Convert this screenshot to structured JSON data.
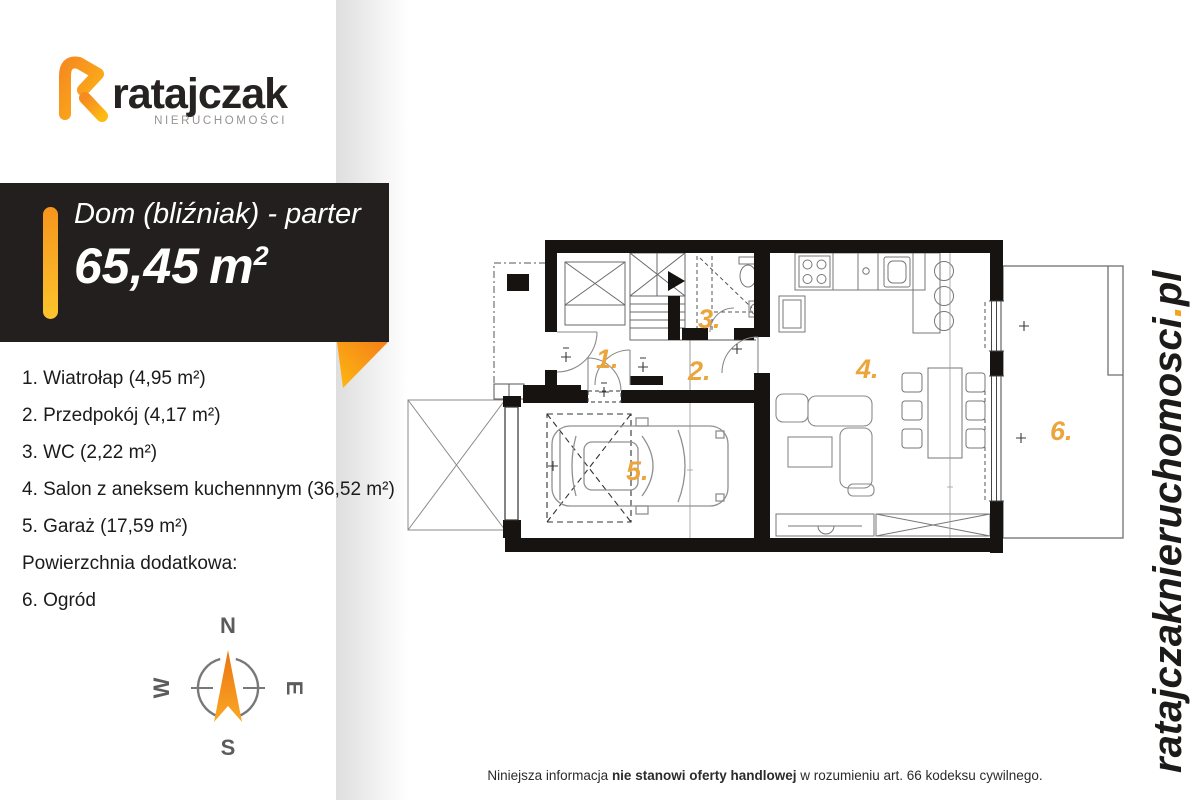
{
  "colors": {
    "accent_orange": "#F0A132",
    "banner_background": "#221F1E",
    "wall_black": "#171310"
  },
  "brand": {
    "name": "ratajczak",
    "tagline": "NIERUCHOMOŚCI"
  },
  "banner": {
    "title": "Dom (bliźniak) - parter",
    "area_value": "65,45",
    "area_unit": "m",
    "area_sup": "2"
  },
  "room_list": {
    "items": [
      {
        "label": "1. Wiatrołap (4,95 m²)"
      },
      {
        "label": "2. Przedpokój (4,17 m²)"
      },
      {
        "label": "3. WC (2,22 m²)"
      },
      {
        "label": "4. Salon z aneksem kuchennnym (36,52 m²)"
      },
      {
        "label": "5. Garaż (17,59 m²)"
      },
      {
        "label": "Powierzchnia dodatkowa:"
      },
      {
        "label": "6. Ogród"
      }
    ]
  },
  "compass": {
    "north": "N",
    "south": "S",
    "east": "E",
    "west": "W"
  },
  "floor_plan": {
    "rooms": [
      {
        "label": "1."
      },
      {
        "label": "2."
      },
      {
        "label": "3."
      },
      {
        "label": "4."
      },
      {
        "label": "5."
      },
      {
        "label": "6."
      }
    ]
  },
  "website": {
    "name": "ratajczaknieruchomosci",
    "dot": ".",
    "tld": "pl"
  },
  "footer": {
    "prefix": "Niniejsza informacja ",
    "bold": "nie stanowi oferty handlowej",
    "suffix": " w rozumieniu art. 66 kodeksu cywilnego."
  }
}
